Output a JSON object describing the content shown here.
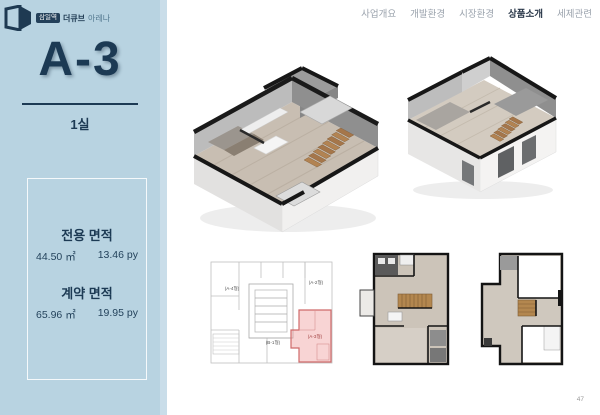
{
  "page": {
    "number": "47"
  },
  "nav": {
    "items": [
      {
        "label": "사업개요"
      },
      {
        "label": "개발환경"
      },
      {
        "label": "시장환경"
      },
      {
        "label": "상품소개"
      },
      {
        "label": "세제관련"
      }
    ]
  },
  "sidebar": {
    "brand": {
      "badge": "삼일역",
      "name": "더큐브",
      "suffix": "아레나"
    },
    "unit_type": "A-3",
    "room_count": "1실",
    "area_exclusive": {
      "label": "전용 면적",
      "sqm": "44.50 ㎡",
      "py": "13.46 py"
    },
    "area_contract": {
      "label": "계약 면적",
      "sqm": "65.96 ㎡",
      "py": "19.95 py"
    }
  },
  "keyplan": {
    "unit_a4": "(A-4형)",
    "unit_a2": "(A-2형)",
    "unit_a3": "(A-3형)",
    "unit_b1": "(B-1형)"
  },
  "colors": {
    "sidebar_bg": "#b8d3e1",
    "navy": "#1c3a54",
    "highlight_red": "#cf6a6a",
    "wood_floor": "#c8beb2",
    "stair_wood": "#ad7f4f"
  }
}
